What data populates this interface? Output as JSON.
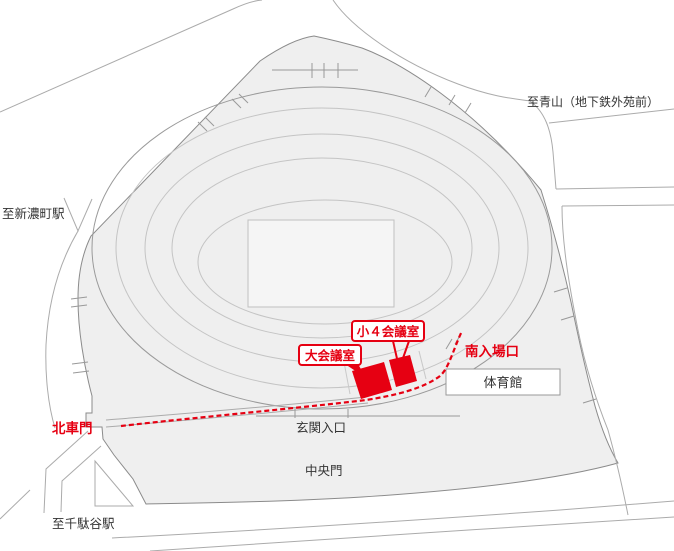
{
  "map": {
    "stations": {
      "aoyama": "至青山（地下鉄外苑前）",
      "shinanomachi": "至新濃町駅",
      "sendagaya": "至千駄谷駅"
    },
    "gates": {
      "north_gate": "北車門",
      "central_gate": "中央門",
      "entrance": "玄関入口",
      "south_entrance": "南入場口"
    },
    "rooms": {
      "large": "大会議室",
      "small4": "小４会議室"
    },
    "buildings": {
      "gymnasium": "体育館"
    },
    "colors": {
      "accent_red": "#e60012",
      "site_fill": "#efefef",
      "road_line": "#ababab",
      "boundary_gray": "#8b8b8b",
      "ring_line": "#c4c4c4",
      "text_dark": "#333333"
    }
  }
}
